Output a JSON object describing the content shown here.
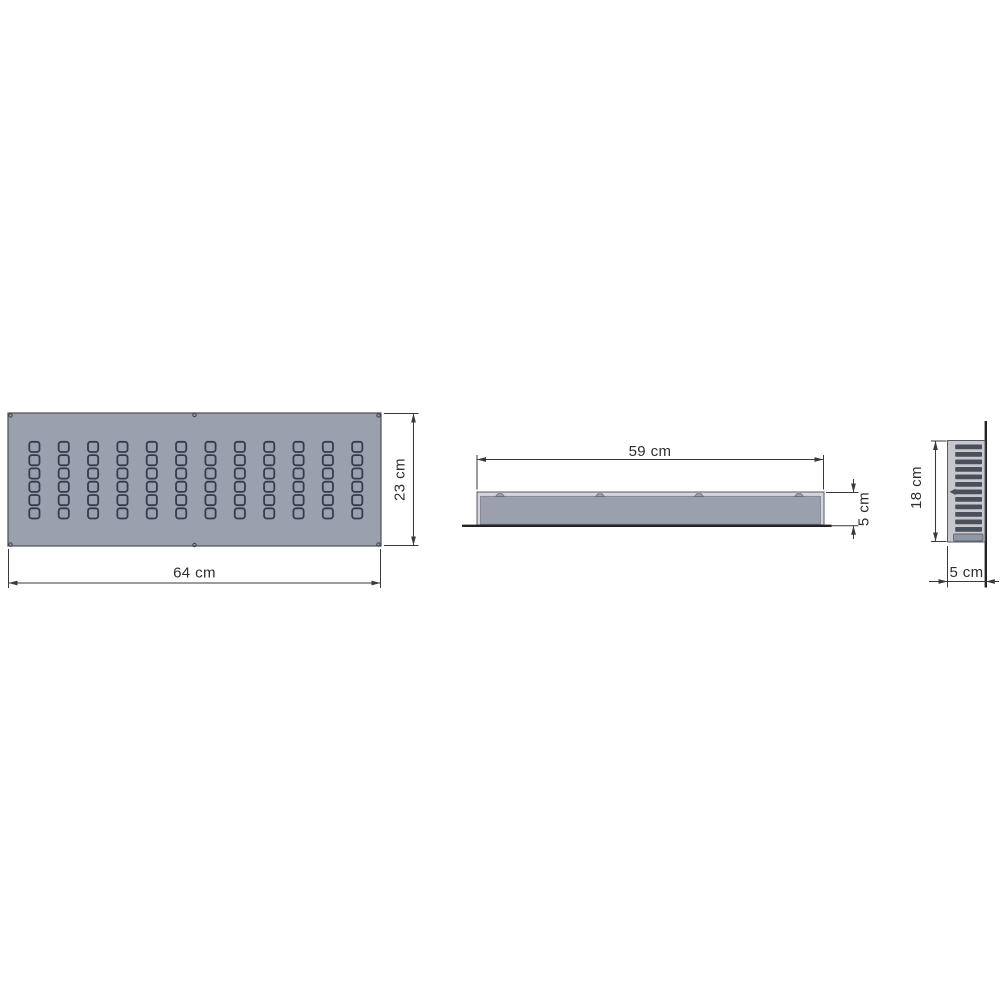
{
  "drawing": {
    "kind": "technical-drawing",
    "subject": "perforated ventilation grille, three orthographic views",
    "background": "#ffffff"
  },
  "views": {
    "front": {
      "width_label": "64 cm",
      "height_label": "23 cm",
      "hole_columns": 12,
      "hole_rows": 6,
      "screw_hole_count": 6
    },
    "top": {
      "width_label": "59 cm",
      "height_label": "5 cm",
      "clip_count": 4
    },
    "side": {
      "height_label": "18 cm",
      "width_label": "5 cm",
      "louver_count": 12
    }
  },
  "colors": {
    "panel_fill": "#9ba0af",
    "panel_stroke": "#4a4e58",
    "hole_stroke": "#333b4d",
    "screw_stroke": "#3c404a",
    "frame_light": "#d4d6de",
    "frame_stroke": "#55585f",
    "inner_stroke": "#7b7f8b",
    "bump_stroke": "#6d717d",
    "side_body": "#c6c8ce",
    "side_body_stroke": "#555a64",
    "louver": "#4a4f5a",
    "louver_bottom_bar": "#9098a4",
    "louver_bottom_bar_stroke": "#61656f",
    "wall_line": "#222222",
    "dimension_line": "#3a3a3a",
    "text": "#2e2e2e"
  }
}
